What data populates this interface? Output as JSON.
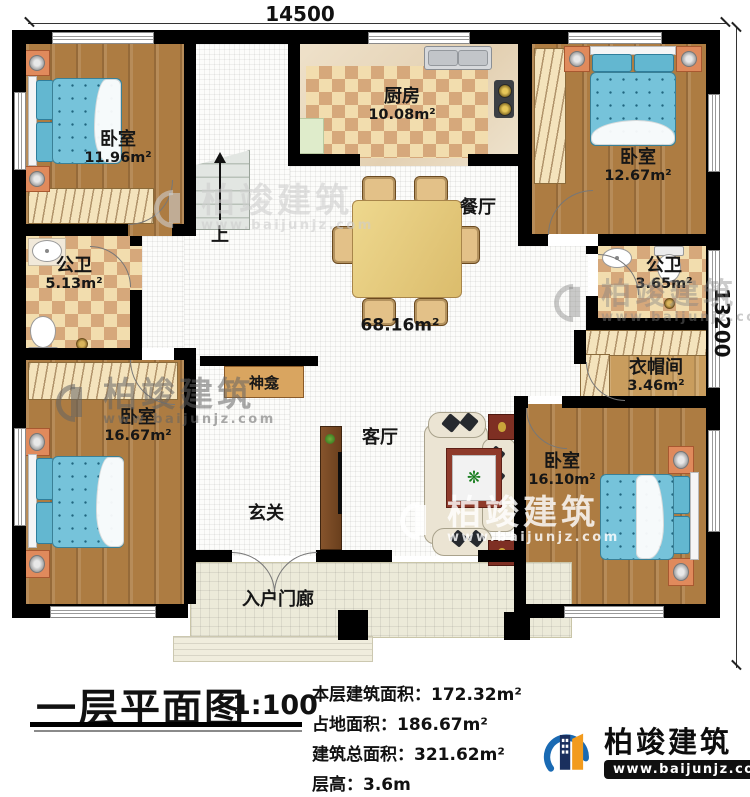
{
  "plan": {
    "dimensions": {
      "top": "14500",
      "right": "13200"
    },
    "stairs_label": "上",
    "rooms": {
      "bedroom_tl": {
        "label": "卧室",
        "area": "11.96m²"
      },
      "kitchen": {
        "label": "厨房",
        "area": "10.08m²"
      },
      "bedroom_tr": {
        "label": "卧室",
        "area": "12.67m²"
      },
      "bath_left": {
        "label": "公卫",
        "area": "5.13m²"
      },
      "bath_right": {
        "label": "公卫",
        "area": "3.65m²"
      },
      "dining": {
        "label": "餐厅"
      },
      "hall": {
        "area": "68.16m²"
      },
      "shrine": {
        "label": "神龛"
      },
      "living": {
        "label": "客厅"
      },
      "cloakroom": {
        "label": "衣帽间",
        "area": "3.46m²"
      },
      "bedroom_bl": {
        "label": "卧室",
        "area": "16.67m²"
      },
      "bedroom_br": {
        "label": "卧室",
        "area": "16.10m²"
      },
      "entry": {
        "label": "玄关"
      },
      "porch": {
        "label": "入户门廊"
      }
    }
  },
  "icons": {
    "plant": "❋"
  },
  "watermark": {
    "name": "柏竣建筑",
    "url": "www.baijunjz.com"
  },
  "titleblock": {
    "title": "一层平面图",
    "scale": "1:100",
    "stats": [
      {
        "label": "本层建筑面积：",
        "value": "172.32m²"
      },
      {
        "label": "占地面积：",
        "value": "186.67m²"
      },
      {
        "label": "建筑总面积：",
        "value": "321.62m²"
      },
      {
        "label": "层高：",
        "value": "3.6m"
      }
    ],
    "brand": {
      "name": "柏竣建筑",
      "url": "www.baijunjz.com"
    }
  },
  "palette": {
    "wall": "#000000",
    "wood": "#ad7c42",
    "checker": "#d6a87b",
    "bed": "#76c3da",
    "brand_blue": "#1a6ab3",
    "brand_orange": "#f29b1d"
  }
}
